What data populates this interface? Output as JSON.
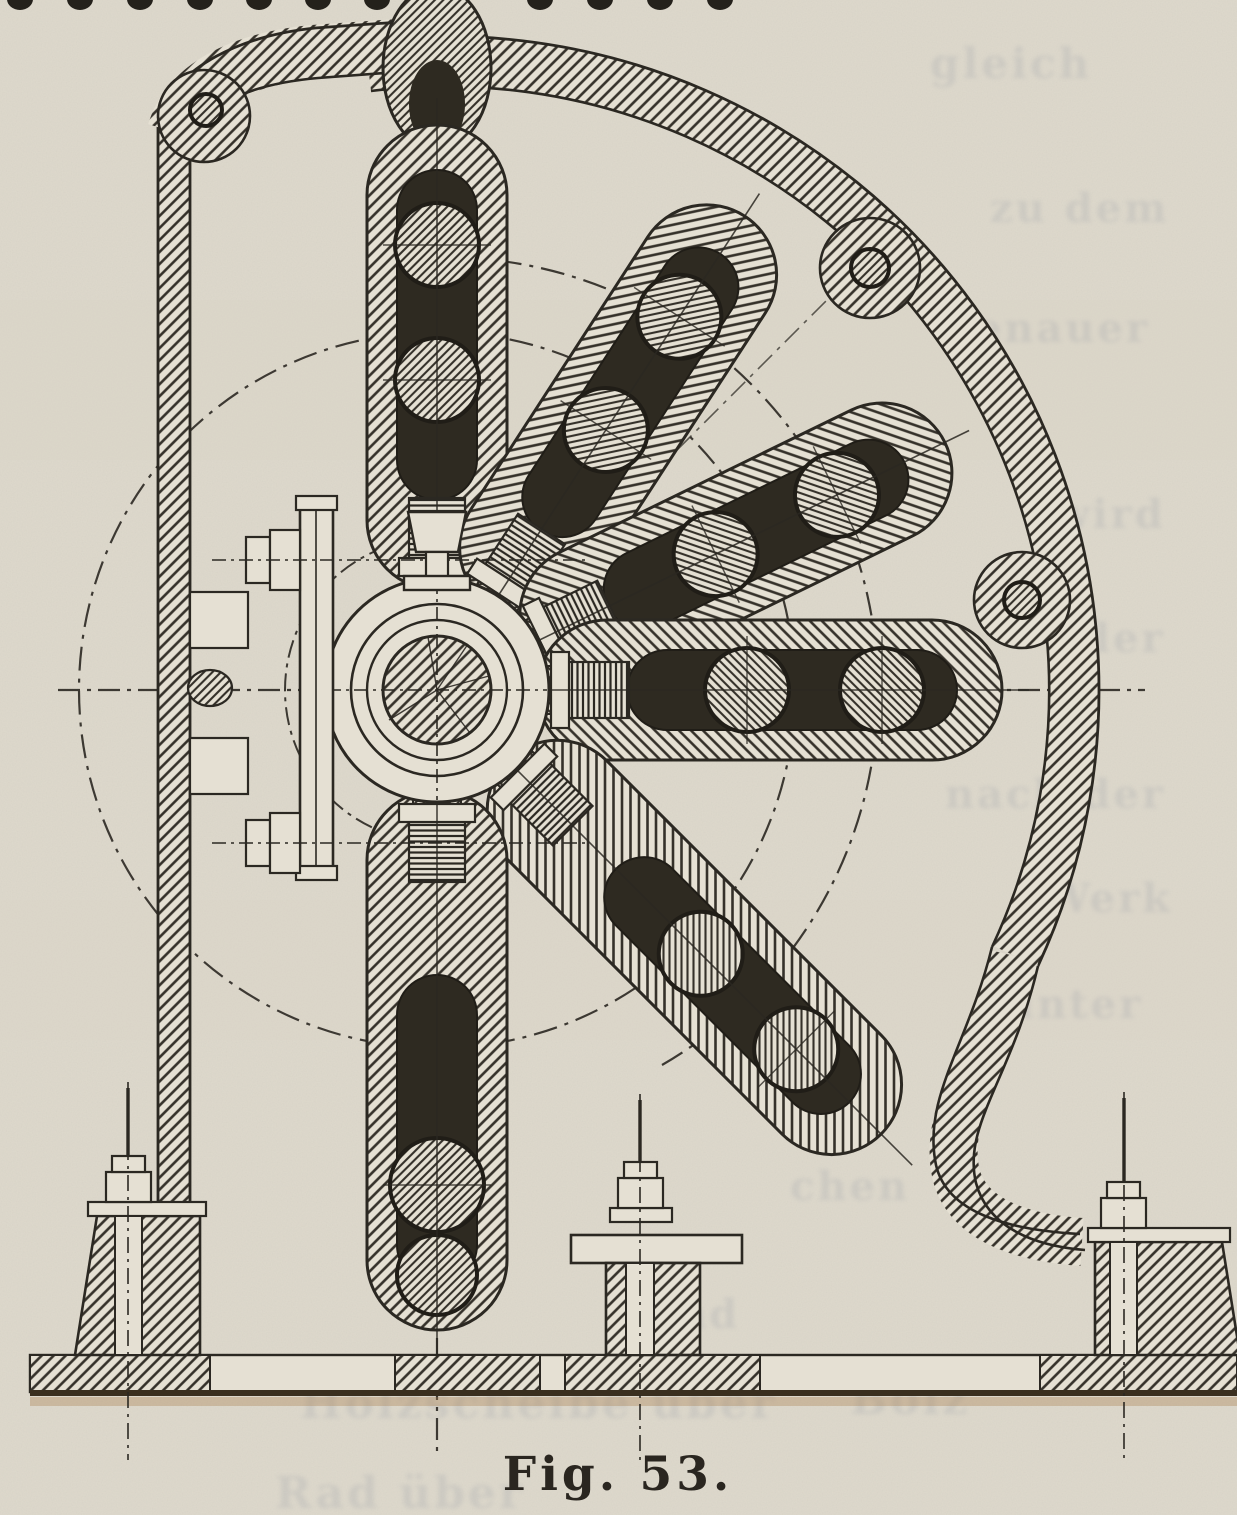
{
  "figure": {
    "caption": "Fig. 53."
  },
  "ghost": [
    "gleich",
    "zu dem",
    "genauer",
    "wird",
    "der",
    "nach der",
    "Werk",
    "unter",
    "chen",
    "und",
    "Holzscheibe über",
    "Bolz",
    "Rad über"
  ],
  "top_dots": {
    "count": 11
  },
  "palette": {
    "paper": "#e5e0d3",
    "paper_shade": "#d9d4c6",
    "ink": "#2b2822",
    "hatch": "#35312a",
    "slot_dark": "#2e2a21",
    "hole_ring": "#201d17",
    "ghost_ink": "#7b8496",
    "base_shadow": "#a97f4e"
  }
}
